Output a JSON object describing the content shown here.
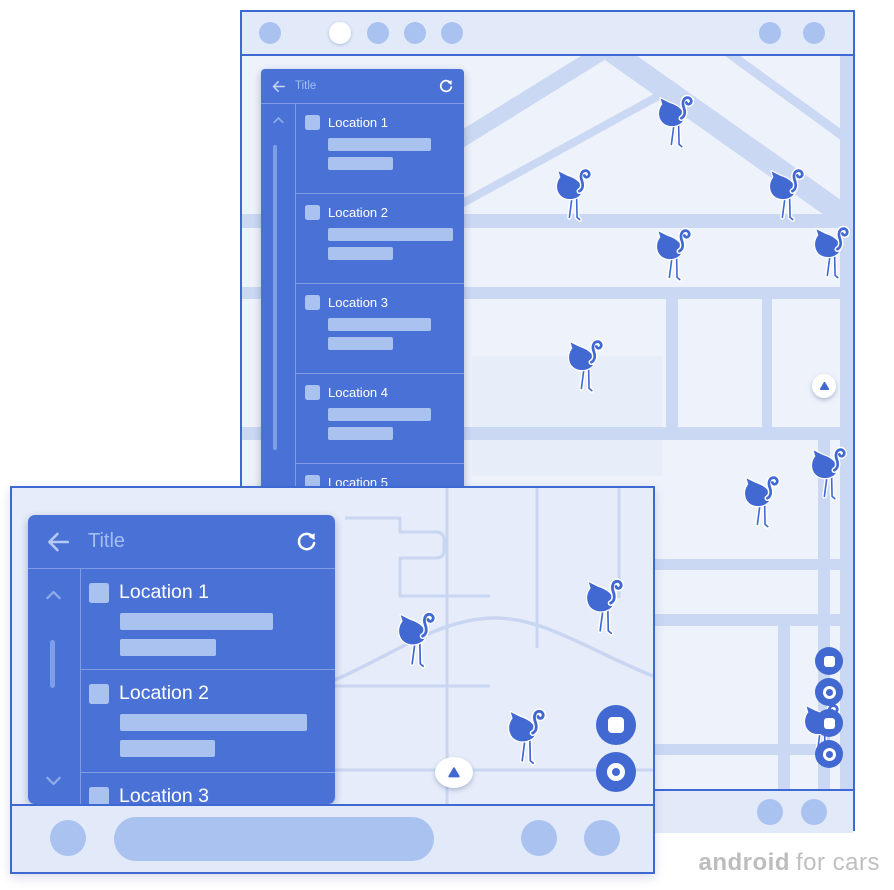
{
  "brand": {
    "bold": "android",
    "regular": "for cars"
  },
  "colors": {
    "accent_blue": "#4A72D6",
    "marker_blue": "#4169D1",
    "light_blue": "#A9C2F0",
    "frame_border": "#3E69D3",
    "bar_bg": "#E2EAF9",
    "map_bg": "#EEF2FB",
    "map_bg_landscape": "#E6ECF9",
    "road": "#CBD8F3",
    "title_text": "#A3BDF1",
    "white": "#FFFFFF",
    "brand_gray": "#BFBFBF"
  },
  "icons": {
    "back": "back-arrow-icon",
    "refresh": "refresh-icon",
    "scroll_up": "chevron-up-icon",
    "scroll_down": "chevron-down-icon",
    "marker": "flamingo-marker",
    "compass": "compass-triangle-icon",
    "fab_square": "rounded-square-icon",
    "fab_ring": "ring-icon"
  },
  "portrait": {
    "status_bar": {
      "left_dots": 5,
      "active_dot_index": 1,
      "right_dots": 2
    },
    "panel": {
      "title": "Title",
      "items": [
        {
          "label": "Location 1",
          "line_widths": [
            103,
            65
          ]
        },
        {
          "label": "Location 2",
          "line_widths": [
            125,
            65
          ]
        },
        {
          "label": "Location 3",
          "line_widths": [
            103,
            65
          ]
        },
        {
          "label": "Location 4",
          "line_widths": [
            103,
            65
          ]
        },
        {
          "label": "Location 5",
          "line_widths": [
            103,
            65
          ]
        }
      ]
    },
    "map": {
      "markers": [
        {
          "x": 413,
          "y": 36,
          "w": 40,
          "h": 56
        },
        {
          "x": 311,
          "y": 109,
          "w": 40,
          "h": 56
        },
        {
          "x": 411,
          "y": 169,
          "w": 40,
          "h": 56
        },
        {
          "x": 524,
          "y": 109,
          "w": 40,
          "h": 56
        },
        {
          "x": 569,
          "y": 167,
          "w": 40,
          "h": 56
        },
        {
          "x": 323,
          "y": 280,
          "w": 40,
          "h": 56
        },
        {
          "x": 499,
          "y": 416,
          "w": 40,
          "h": 56
        },
        {
          "x": 566,
          "y": 388,
          "w": 40,
          "h": 56
        },
        {
          "x": 559,
          "y": 644,
          "w": 40,
          "h": 56
        }
      ],
      "fab_icons": [
        "rounded-square",
        "ring",
        "rounded-square",
        "ring"
      ]
    }
  },
  "landscape": {
    "panel": {
      "title": "Title",
      "items": [
        {
          "label": "Location 1",
          "line_widths": [
            153,
            96
          ]
        },
        {
          "label": "Location 2",
          "line_widths": [
            187,
            95
          ]
        },
        {
          "label": "Location 3",
          "line_widths": [
            150,
            90
          ]
        }
      ]
    },
    "map": {
      "markers": [
        {
          "x": 383,
          "y": 120,
          "w": 42,
          "h": 60
        },
        {
          "x": 571,
          "y": 87,
          "w": 42,
          "h": 60
        },
        {
          "x": 493,
          "y": 217,
          "w": 42,
          "h": 60
        }
      ],
      "fab_icons": [
        "rounded-square",
        "ring"
      ]
    }
  }
}
